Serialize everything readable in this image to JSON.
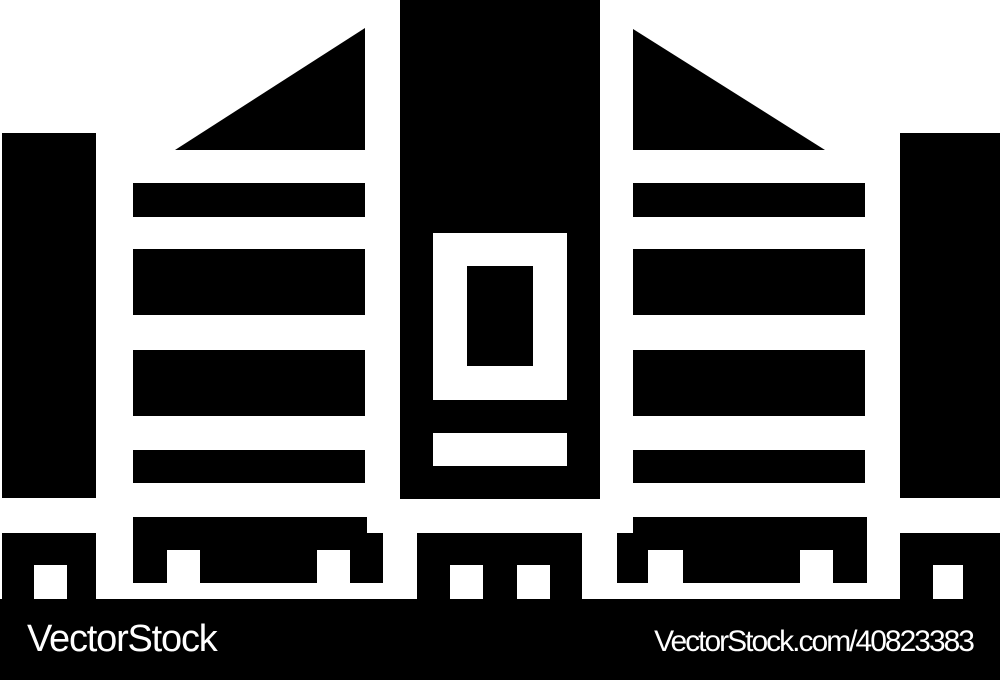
{
  "canvas": {
    "width": 1000,
    "height": 680,
    "background": "#ffffff"
  },
  "icon": {
    "name": "city-buildings-glyph-icon",
    "description": "Black glyph icon of three city buildings: striped left and right towers with angled rooftops, a central tower with a doorway inset, flanking side pillars, and ground blocks with window cutouts",
    "color": "#000000"
  },
  "watermark": {
    "bar_color": "#000000",
    "text_color": "#ffffff",
    "brand_label": "VectorStock",
    "credit_label": "VectorStock.com/40823383"
  }
}
